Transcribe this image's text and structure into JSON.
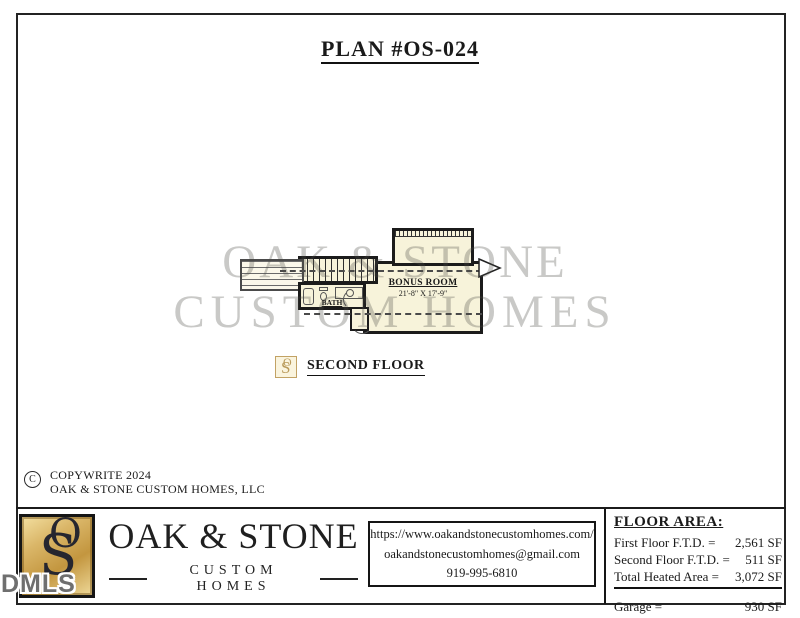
{
  "title": "PLAN #OS-024",
  "watermark": {
    "line1": "OAK & STONE",
    "line2": "CUSTOM HOMES",
    "mls_tag": "DMLS"
  },
  "plan": {
    "bonus_room": {
      "name": "BONUS ROOM",
      "dimensions": "21'-8\" X 17'-9\""
    },
    "bath": {
      "name": "BATH"
    },
    "floor_label": "SECOND FLOOR"
  },
  "copyright": {
    "symbol": "C",
    "line1": "COPYWRITE 2024",
    "line2": "OAK & STONE CUSTOM HOMES, LLC"
  },
  "footer": {
    "brand": {
      "monogram_o": "O",
      "monogram_s": "S",
      "name": "OAK & STONE",
      "tagline": "CUSTOM HOMES"
    },
    "contact": {
      "website": "https://www.oakandstonecustomhomes.com/",
      "email": "oakandstonecustomhomes@gmail.com",
      "phone": "919-995-6810"
    },
    "floor_area": {
      "heading": "FLOOR AREA:",
      "rows": [
        {
          "label": "First Floor F.T.D. =",
          "value": "2,561 SF"
        },
        {
          "label": "Second Floor F.T.D. =",
          "value": "511 SF"
        },
        {
          "label": "Total Heated Area =",
          "value": "3,072 SF"
        }
      ],
      "garage_label": "Garage =",
      "garage_value": "930 SF"
    }
  },
  "colors": {
    "plan_fill": "#f7f3da",
    "wall_ink": "#1b1b1b",
    "gold": "#c89a4a",
    "watermark_gray": "#bdbdbd"
  }
}
